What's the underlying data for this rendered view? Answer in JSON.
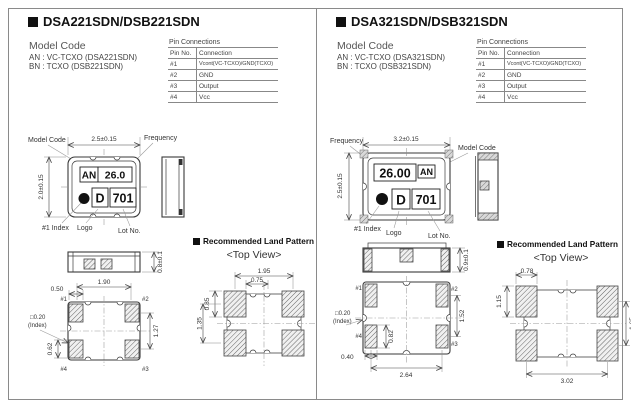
{
  "left": {
    "title": "DSA221SDN/DSB221SDN",
    "model_code": {
      "heading": "Model Code",
      "line1": "AN : VC-TCXO (DSA221SDN)",
      "line2": "BN : TCXO (DSB221SDN)"
    },
    "pin_connections": {
      "caption": "Pin Connections",
      "col_pin": "Pin No.",
      "col_conn": "Connection",
      "rows": [
        {
          "no": "#1",
          "conn": "Vcont(VC-TCXO)/GND(TCXO)"
        },
        {
          "no": "#2",
          "conn": "GND"
        },
        {
          "no": "#3",
          "conn": "Output"
        },
        {
          "no": "#4",
          "conn": "Vcc"
        }
      ]
    },
    "package": {
      "dim_width": "2.5±0.15",
      "dim_height": "2.0±0.15",
      "label_model_code": "Model Code",
      "label_frequency": "Frequency",
      "label_index": "#1 Index",
      "label_logo": "Logo",
      "label_lot": "Lot No.",
      "mark_model": "AN",
      "mark_freq": "26.0",
      "mark_logo": "D",
      "mark_lot": "701"
    },
    "side_view": {
      "dim_thickness": "0.8±0.1"
    },
    "bottom_view": {
      "dim_pad_w": "0.50",
      "dim_pitch_x": "1.90",
      "index_mark": "□0.20",
      "index_label": "(Index)",
      "dim_pitch_y": "1.27",
      "dim_pad_h": "0.62",
      "pin1": "#1",
      "pin2": "#2",
      "pin3": "#3",
      "pin4": "#4"
    },
    "land_pattern": {
      "heading": "Recommended Land Pattern",
      "subheading": "<Top View>",
      "dim_pitch_x": "1.95",
      "dim_pad_h": "0.85",
      "dim_gap": "0.75",
      "dim_pitch_y": "1.35"
    }
  },
  "right": {
    "title": "DSA321SDN/DSB321SDN",
    "model_code": {
      "heading": "Model Code",
      "line1": "AN : VC-TCXO (DSA321SDN)",
      "line2": "BN : TCXO (DSB321SDN)"
    },
    "pin_connections": {
      "caption": "Pin Connections",
      "col_pin": "Pin No.",
      "col_conn": "Connection",
      "rows": [
        {
          "no": "#1",
          "conn": "Vcont(VC-TCXO)/GND(TCXO)"
        },
        {
          "no": "#2",
          "conn": "GND"
        },
        {
          "no": "#3",
          "conn": "Output"
        },
        {
          "no": "#4",
          "conn": "Vcc"
        }
      ]
    },
    "package": {
      "dim_width": "3.2±0.15",
      "dim_height": "2.5±0.15",
      "label_model_code": "Model Code",
      "label_frequency": "Frequency",
      "label_index": "#1 Index",
      "label_logo": "Logo",
      "label_lot": "Lot No.",
      "mark_model": "AN",
      "mark_freq": "26.00",
      "mark_logo": "D",
      "mark_lot": "701"
    },
    "side_view": {
      "dim_thickness": "0.9±0.1"
    },
    "bottom_view": {
      "dim_pad_w": "0.40",
      "dim_pitch_x": "2.64",
      "index_mark": "□0.20",
      "index_label": "(Index)",
      "dim_pitch_y": "1.52",
      "dim_pad_h": "0.82",
      "pin1": "#1",
      "pin2": "#2",
      "pin3": "#3",
      "pin4": "#4"
    },
    "land_pattern": {
      "heading": "Recommended Land Pattern",
      "subheading": "<Top View>",
      "dim_pad_w": "0.78",
      "dim_pad_h": "1.15",
      "dim_pitch_y": "1.65",
      "dim_pitch_x": "3.02"
    }
  }
}
